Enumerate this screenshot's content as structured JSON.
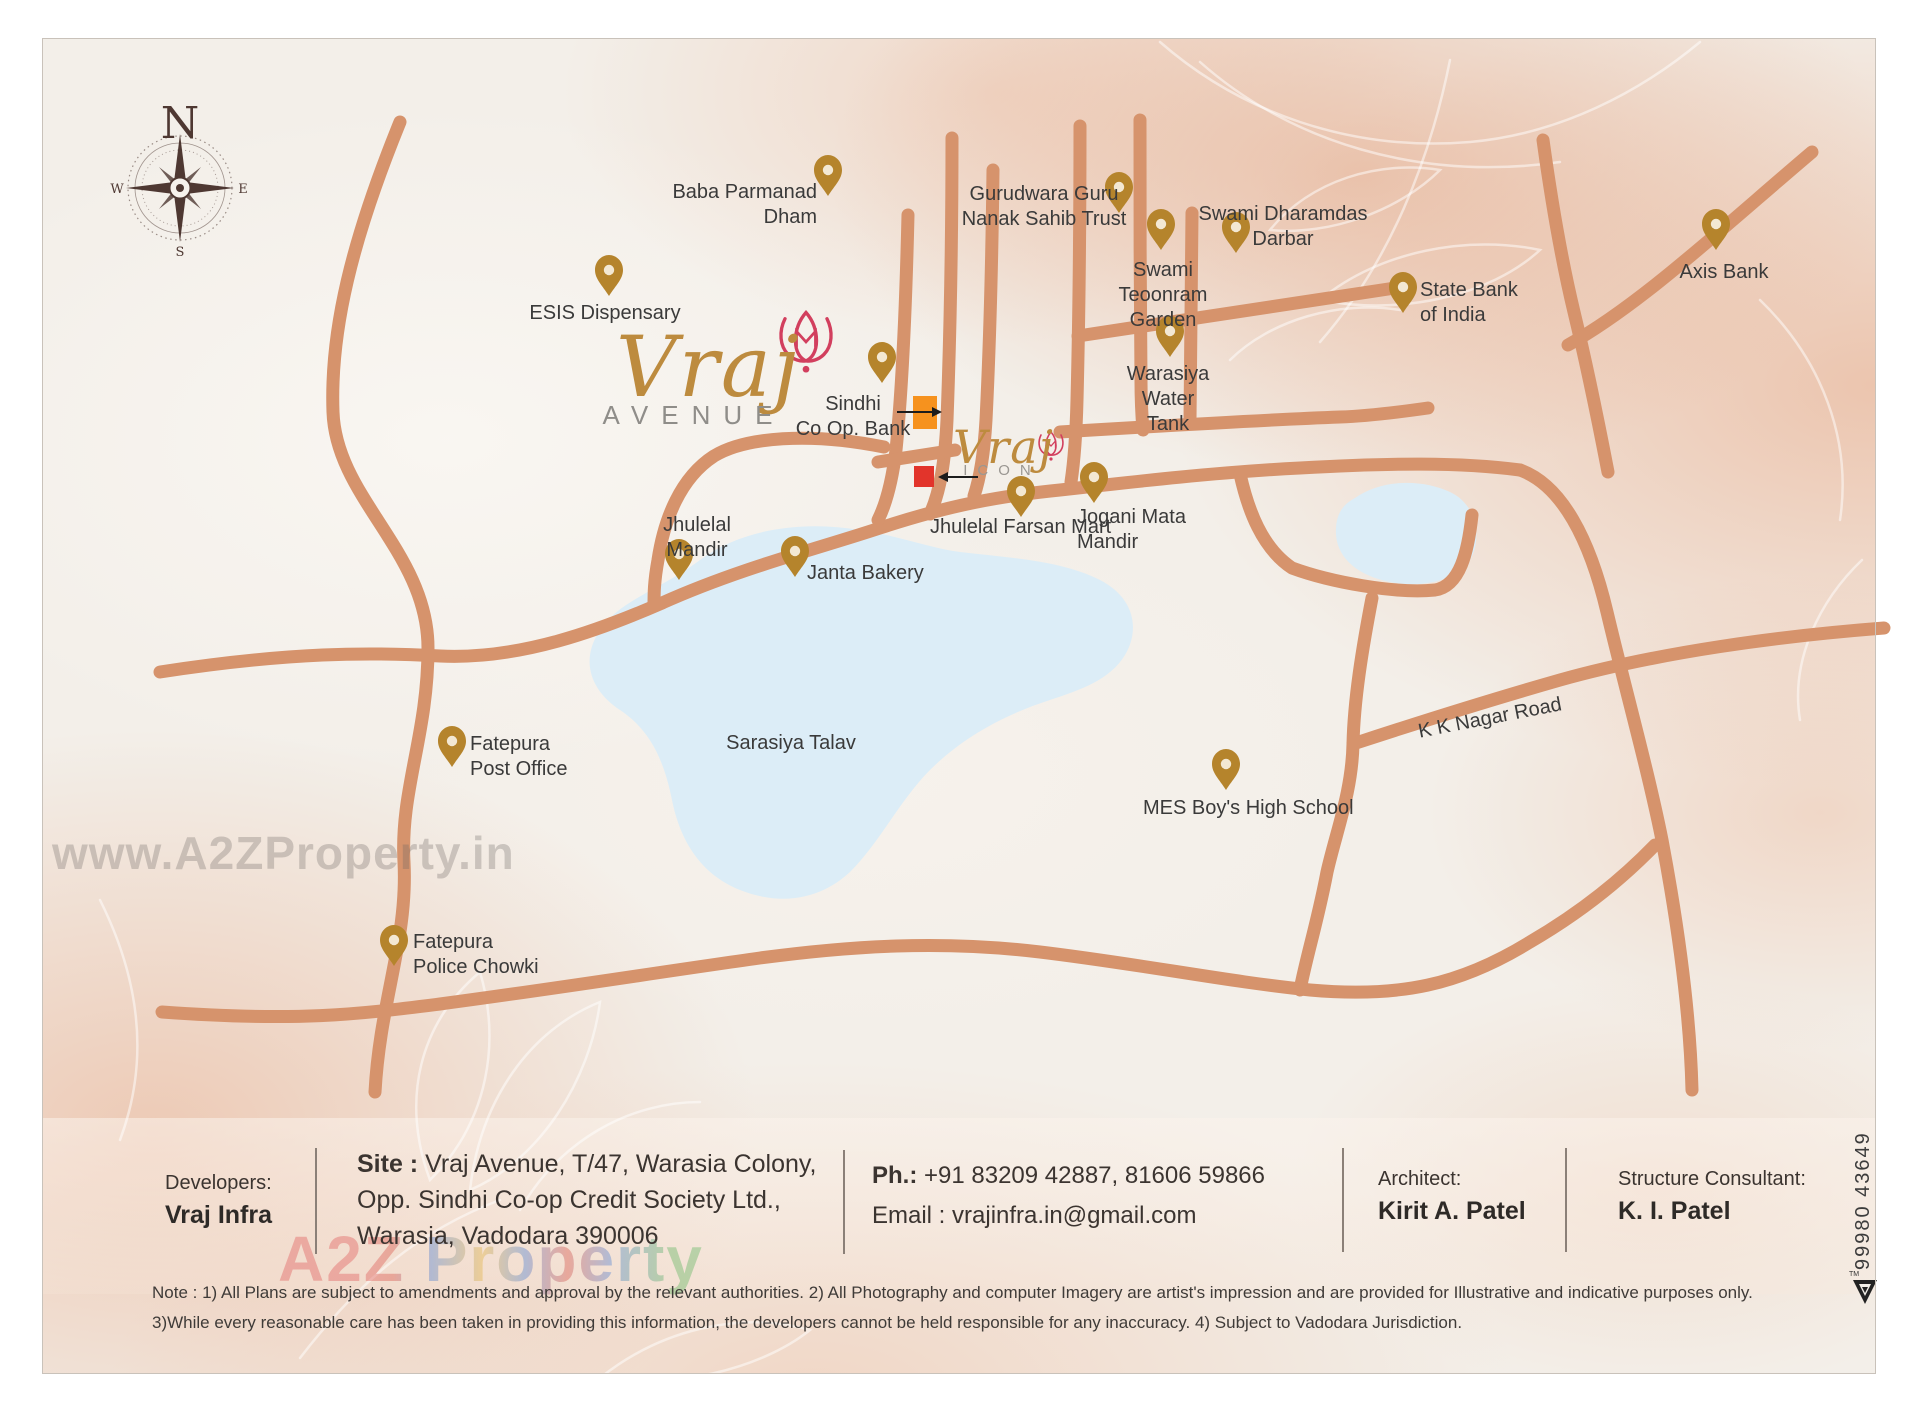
{
  "page": {
    "title": "Vraj Avenue Location Map"
  },
  "map": {
    "compass": {
      "n": "N",
      "e": "E",
      "s": "S",
      "w": "W"
    },
    "brand": {
      "avenue_name": "Vraj",
      "avenue_sub": "AVENUE",
      "icon_name": "Vraj",
      "icon_sub": "ICON"
    },
    "colors": {
      "road": "#d6936c",
      "lake": "#dcedf7",
      "pin": "#b5842c",
      "tulip": "#d23f5e",
      "site_square_avenue": "#f6921e",
      "site_square_icon": "#e2342b",
      "gold_logo": "#bd8b3e"
    },
    "landmarks": [
      {
        "label": "Baba Parmanad\nDham"
      },
      {
        "label": "ESIS Dispensary"
      },
      {
        "label": "Gurudwara Guru\nNanak Sahib Trust"
      },
      {
        "label": "Swami Dharamdas\nDarbar"
      },
      {
        "label": "Swami\nTeoonram\nGarden"
      },
      {
        "label": "Warasiya\nWater\nTank"
      },
      {
        "label": "State Bank\nof India"
      },
      {
        "label": "Axis Bank"
      },
      {
        "label": "Sindhi\nCo Op. Bank"
      },
      {
        "label": "Jhulelal\nMandir"
      },
      {
        "label": "Janta Bakery"
      },
      {
        "label": "Jhulelal Farsan Mart"
      },
      {
        "label": "Jogani Mata\nMandir"
      },
      {
        "label": "Sarasiya Talav"
      },
      {
        "label": "Fatepura\nPost Office"
      },
      {
        "label": "MES Boy's High School"
      },
      {
        "label": "K K Nagar Road"
      },
      {
        "label": "Fatepura\nPolice Chowki"
      }
    ],
    "watermark": "www.A2ZProperty.in"
  },
  "footer": {
    "developers_label": "Developers:",
    "developers_name": "Vraj Infra",
    "site_bold": "Site :",
    "site_line1": " Vraj Avenue, T/47, Warasia Colony,",
    "site_line2": "Opp. Sindhi Co-op Credit Society Ltd.,",
    "site_line3": "Warasia, Vadodara 390006",
    "phone_label": "Ph.:",
    "phone_numbers": "  +91 83209 42887, 81606 59866",
    "email_line": "Email : vrajinfra.in@gmail.com",
    "architect_label": "Architect:",
    "architect_name": "Kirit A. Patel",
    "consultant_label": "Structure Consultant:",
    "consultant_name": "K. I. Patel",
    "watermark": "A2Z Property"
  },
  "note": {
    "line1": "Note : 1) All Plans are subject to amendments and approval by the relevant authorities. 2) All Photography and computer Imagery are artist's impression and are provided for Illustrative and indicative purposes only.",
    "line2": "3)While every reasonable care has been taken in providing this information, the developers cannot be held responsible for any inaccuracy. 4) Subject to Vadodara Jurisdiction."
  },
  "side": {
    "phone": "99980 43649"
  }
}
